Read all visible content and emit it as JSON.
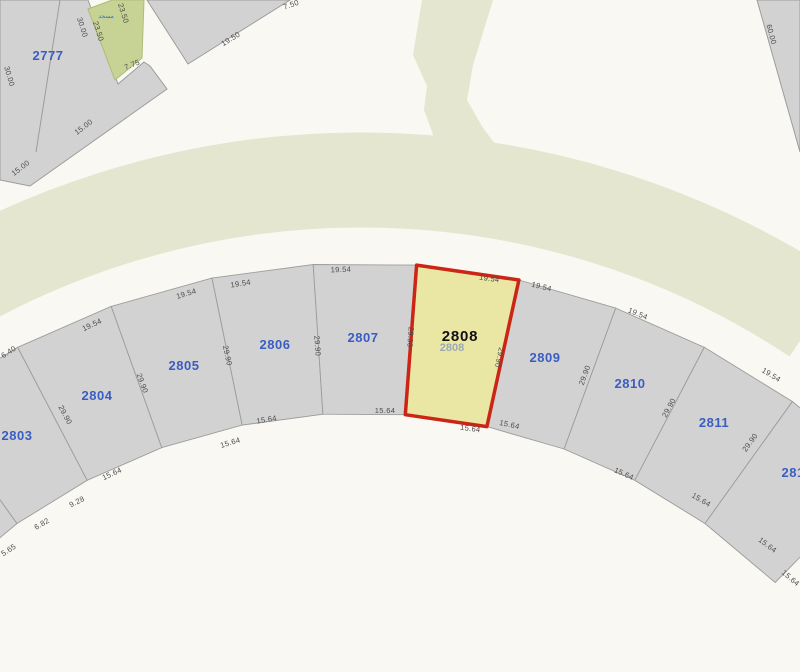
{
  "map": {
    "type": "cadastral-parcel-map",
    "highlighted_parcel": "2808",
    "colors": {
      "background": "#faf8f2",
      "road_green": "#e4e6cf",
      "parcel_gray": "#d2d2d2",
      "parcel_border": "#9c9c9c",
      "mosque_green": "#c7d395",
      "highlight_fill": "#eae7a5",
      "highlight_border": "#cb2516",
      "parcel_number_blue": "#3a5dc3",
      "dimension_text": "#4d4d4d"
    },
    "geometry": {
      "cx": 361,
      "cy": 1004,
      "r_outer": 741,
      "r_inner": 591,
      "green_arc_r": 824,
      "green_arc_w": 95
    },
    "arc_parcels": [
      {
        "id": "",
        "t1": -44.0,
        "t2": -35.6,
        "lx": null,
        "ly": null
      },
      {
        "id": "2803",
        "t1": -35.6,
        "t2": -27.6,
        "lx": 17,
        "ly": 440
      },
      {
        "id": "2804",
        "t1": -27.6,
        "t2": -19.7,
        "lx": 97,
        "ly": 400
      },
      {
        "id": "2805",
        "t1": -19.7,
        "t2": -11.6,
        "lx": 184,
        "ly": 370
      },
      {
        "id": "2806",
        "t1": -11.6,
        "t2": -3.7,
        "lx": 275,
        "ly": 349
      },
      {
        "id": "2807",
        "t1": -3.7,
        "t2": 4.3,
        "lx": 363,
        "ly": 342
      },
      {
        "id": "2808",
        "t1": 4.3,
        "t2": 12.3,
        "lx": 460,
        "ly": 341,
        "highlight": true
      },
      {
        "id": "2809",
        "t1": 12.3,
        "t2": 20.1,
        "lx": 545,
        "ly": 362
      },
      {
        "id": "2810",
        "t1": 20.1,
        "t2": 27.6,
        "lx": 630,
        "ly": 388
      },
      {
        "id": "2811",
        "t1": 27.6,
        "t2": 35.6,
        "lx": 714,
        "ly": 427
      },
      {
        "id": "2812",
        "t1": 35.6,
        "t2": 44.5,
        "lx": 797,
        "ly": 477
      }
    ],
    "highlight_ghost_label": {
      "text": "2808",
      "x": 452,
      "y": 351
    },
    "dimension_labels": [
      {
        "t": "6.40",
        "x": 10,
        "y": 354,
        "r": -33
      },
      {
        "t": "19.54",
        "x": 93,
        "y": 327,
        "r": -25
      },
      {
        "t": "19.54",
        "x": 187,
        "y": 296,
        "r": -17
      },
      {
        "t": "19.54",
        "x": 241,
        "y": 286,
        "r": -9
      },
      {
        "t": "19.54",
        "x": 341,
        "y": 272,
        "r": -2
      },
      {
        "t": "19.54",
        "x": 489,
        "y": 281,
        "r": 8
      },
      {
        "t": "19.54",
        "x": 541,
        "y": 289,
        "r": 14
      },
      {
        "t": "19.54",
        "x": 637,
        "y": 316,
        "r": 22
      },
      {
        "t": "19.54",
        "x": 770,
        "y": 377,
        "r": 31
      },
      {
        "t": "15.64",
        "x": 113,
        "y": 476,
        "r": -25
      },
      {
        "t": "15.64",
        "x": 231,
        "y": 445,
        "r": -17
      },
      {
        "t": "15.64",
        "x": 267,
        "y": 422,
        "r": -9
      },
      {
        "t": "15.64",
        "x": 385,
        "y": 413,
        "r": 0
      },
      {
        "t": "15.64",
        "x": 470,
        "y": 431,
        "r": 8
      },
      {
        "t": "15.64",
        "x": 509,
        "y": 427,
        "r": 12
      },
      {
        "t": "15.64",
        "x": 623,
        "y": 476,
        "r": 24
      },
      {
        "t": "15.64",
        "x": 700,
        "y": 502,
        "r": 30
      },
      {
        "t": "15.64",
        "x": 766,
        "y": 547,
        "r": 37
      },
      {
        "t": "15.64",
        "x": 789,
        "y": 580,
        "r": 40
      },
      {
        "t": "9.28",
        "x": 78,
        "y": 504,
        "r": -27
      },
      {
        "t": "6.82",
        "x": 43,
        "y": 526,
        "r": -30
      },
      {
        "t": "5.65",
        "x": 10,
        "y": 552,
        "r": -33
      },
      {
        "t": "29.90",
        "x": 63,
        "y": 416,
        "r": 62
      },
      {
        "t": "29.90",
        "x": 140,
        "y": 384,
        "r": 70
      },
      {
        "t": "29.90",
        "x": 225,
        "y": 356,
        "r": 78
      },
      {
        "t": "29.90",
        "x": 315,
        "y": 346,
        "r": 86
      },
      {
        "t": "29.90",
        "x": 408,
        "y": 337,
        "r": 94
      },
      {
        "t": "29.90",
        "x": 497,
        "y": 357,
        "r": 102
      },
      {
        "t": "29.90",
        "x": 587,
        "y": 376,
        "r": -70
      },
      {
        "t": "29.90",
        "x": 671,
        "y": 409,
        "r": -62
      },
      {
        "t": "29.90",
        "x": 752,
        "y": 444,
        "r": -54
      },
      {
        "t": "30.00",
        "x": 7,
        "y": 77,
        "r": 74
      },
      {
        "t": "30.00",
        "x": 80,
        "y": 28,
        "r": 72
      },
      {
        "t": "23.50",
        "x": 96,
        "y": 32,
        "r": 72
      },
      {
        "t": "23.50",
        "x": 121,
        "y": 14,
        "r": 72
      },
      {
        "t": "7.75",
        "x": 133,
        "y": 67,
        "r": -22
      },
      {
        "t": "15.00",
        "x": 85,
        "y": 129,
        "r": -37
      },
      {
        "t": "15.00",
        "x": 22,
        "y": 170,
        "r": -37
      },
      {
        "t": "19.50",
        "x": 232,
        "y": 41,
        "r": -32
      },
      {
        "t": "7.50",
        "x": 292,
        "y": 7,
        "r": -20
      },
      {
        "t": "60.00",
        "x": 769,
        "y": 35,
        "r": 75
      }
    ],
    "top_left_block": {
      "parcel_number": "2777",
      "parcel_number_xy": [
        48,
        60
      ],
      "mosque_label": "مسجد",
      "mosque_label_xy": [
        106,
        18
      ]
    }
  }
}
